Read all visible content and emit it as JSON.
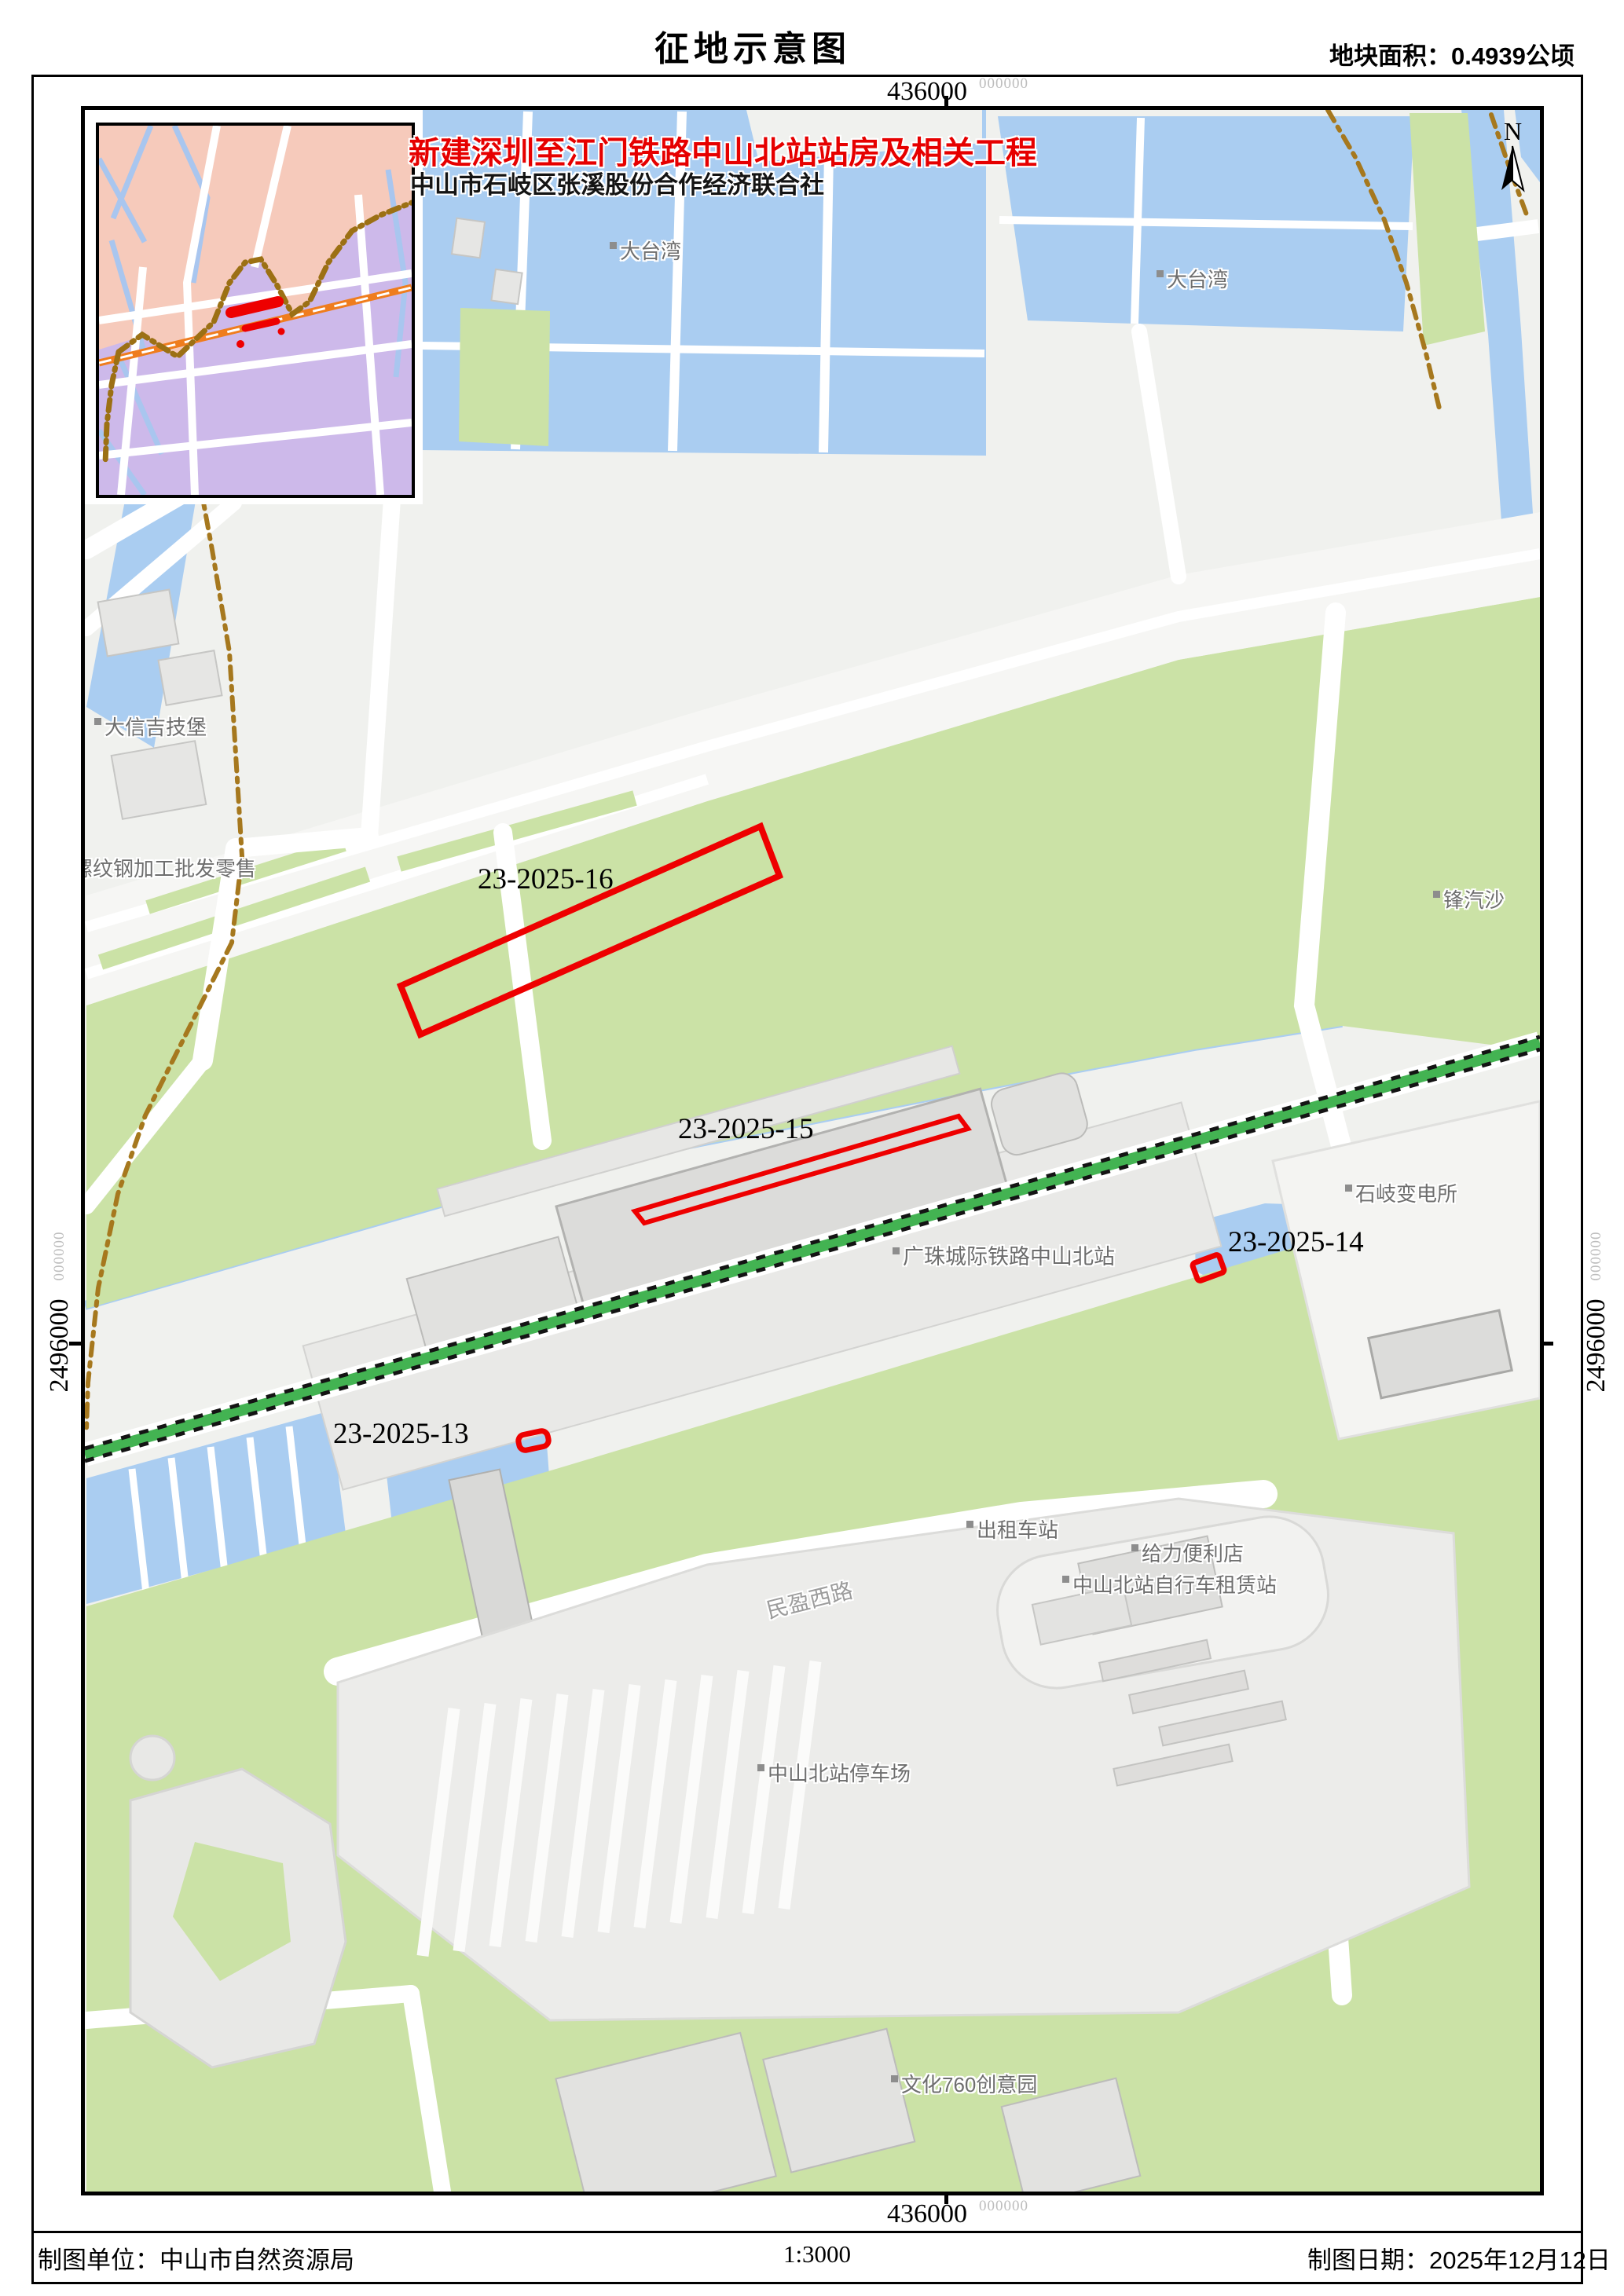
{
  "sheet": {
    "title": "征地示意图",
    "area_note": "地块面积：0.4939公顷"
  },
  "project": {
    "name": "新建深圳至江门铁路中山北站站房及相关工程",
    "org": "中山市石岐区张溪股份合作经济联合社"
  },
  "north": {
    "label": "N"
  },
  "grid": {
    "x_top": "436000",
    "x_top_sub": "000000",
    "x_bottom": "436000",
    "x_bottom_sub": "000000",
    "y_left": "2496000",
    "y_left_sub": "000000",
    "y_right": "2496000",
    "y_right_sub": "000000"
  },
  "parcels": {
    "p16": "23-2025-16",
    "p15": "23-2025-15",
    "p14": "23-2025-14",
    "p13": "23-2025-13"
  },
  "poi": {
    "pond1": "大台湾",
    "pond2": "大台湾",
    "daxin": "大信吉技堡",
    "rebar": "螺纹钢加工批发零售",
    "fengqisha": "锋汽沙",
    "substation": "石岐变电所",
    "station": "广珠城际铁路中山北站",
    "taxi": "出租车站",
    "store": "给力便利店",
    "bike": "中山北站自行车租赁站",
    "road": "民盈西路",
    "parking": "中山北站停车场",
    "park760": "文化760创意园"
  },
  "footer": {
    "agency": "制图单位：中山市自然资源局",
    "scale": "1:3000",
    "date": "制图日期：2025年12月12日"
  },
  "colors": {
    "parcel_red": "#ee0000",
    "railway_green": "#43b352",
    "water_blue": "#aacdf1",
    "vegetation_green": "#cbe2a6",
    "boundary_brown": "#a6781e",
    "inset_pink": "#f6cabb",
    "inset_purple": "#cdb9ea",
    "inset_railway_orange": "#ef7d1e"
  }
}
